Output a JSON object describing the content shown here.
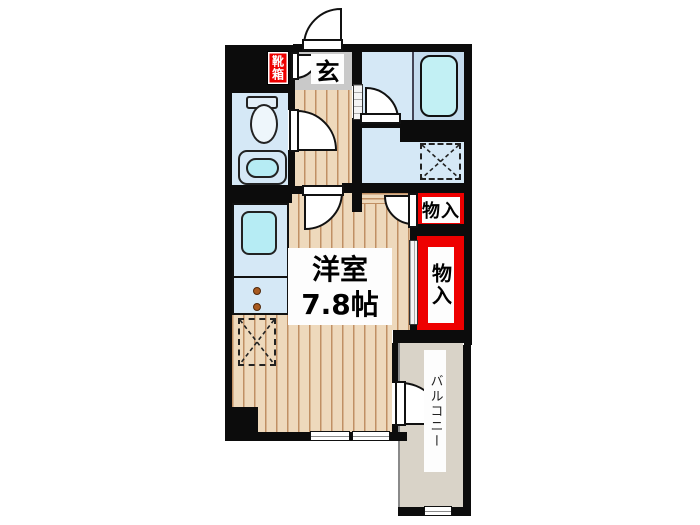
{
  "floorplan": {
    "rooms": {
      "main_room": {
        "label": "洋室",
        "size": "7.8帖"
      },
      "entrance": {
        "label": "玄"
      },
      "shoe_cabinet": {
        "label": "靴箱"
      },
      "storage_small": {
        "label": "物入"
      },
      "storage_large": {
        "label": "物入"
      },
      "balcony": {
        "label": "バルコニー"
      }
    },
    "fixtures": [
      "toilet",
      "washbasin",
      "bathtub",
      "kitchen-sink",
      "stove-burners",
      "refrigerator-space",
      "washing-machine-space",
      "window",
      "doors"
    ],
    "colors": {
      "wall": "#0c0c0c",
      "wood_floor": "#eed9bc",
      "wood_line": "#c09064",
      "room_blue": "#d5e8f6",
      "tub_platform_blue": "#c5dcee",
      "fixture_cyan": "#b6ecf4",
      "entrance_gray": "#c9c9c9",
      "balcony_gray": "#d9d3c8",
      "accent_red": "#ee0000",
      "label_bg": "#ffffff"
    }
  }
}
